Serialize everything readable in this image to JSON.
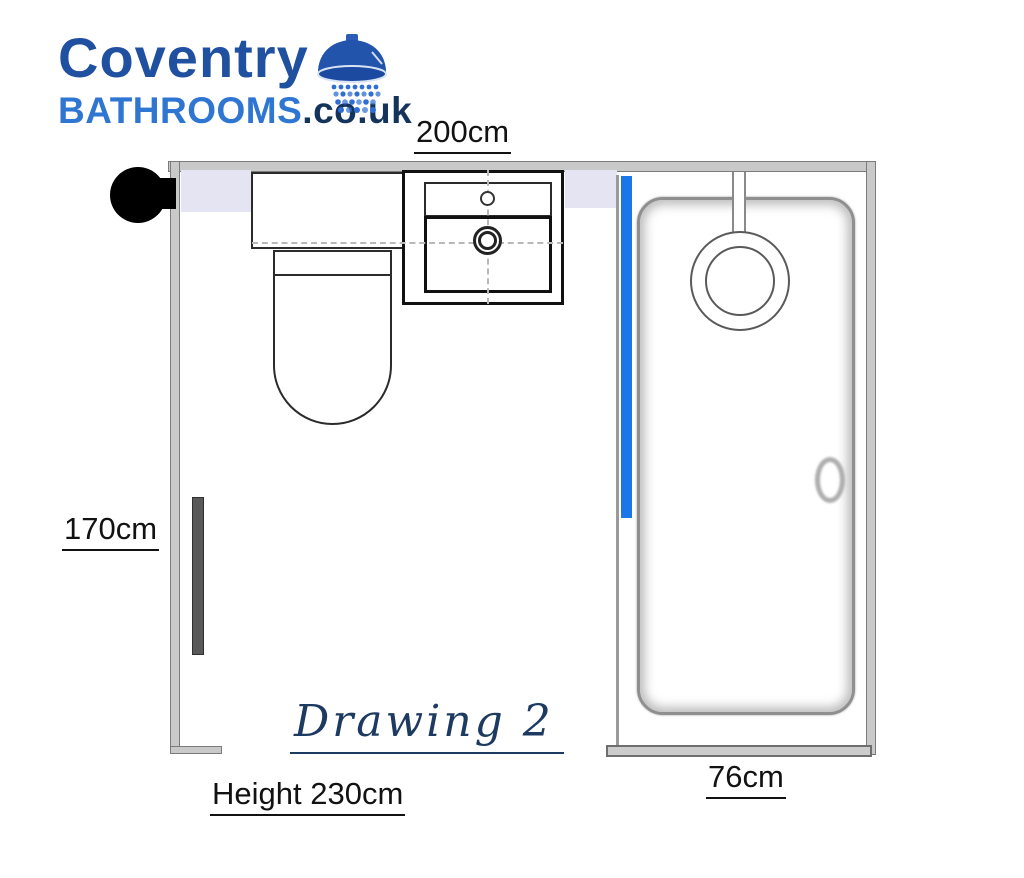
{
  "logo": {
    "line1": "Coventry",
    "line2_brand": "BATHROOMS",
    "line2_suffix": ".co.uk",
    "icon": "shower-head-icon",
    "colors": {
      "line1_blue": "#2050A0",
      "brand_blue": "#2F76D2",
      "suffix_navy": "#14345C"
    }
  },
  "dimensions": {
    "top_width": "200cm",
    "left_depth": "170cm",
    "shower_width": "76cm",
    "room_height": "Height 230cm"
  },
  "title": "Drawing 2",
  "fixtures": {
    "items": [
      "door-knob",
      "towel-radiator",
      "toilet",
      "vanity-counter",
      "basin-with-tap",
      "shower-enclosure",
      "shower-screen",
      "shower-drain",
      "door-handle"
    ]
  },
  "colors": {
    "wall_gray": "#c9c9c9",
    "lavender_band": "#e4e4f2",
    "shower_screen_blue": "#1B76E8",
    "title_navy": "#1d3a60",
    "radiator_gray": "#595959"
  }
}
